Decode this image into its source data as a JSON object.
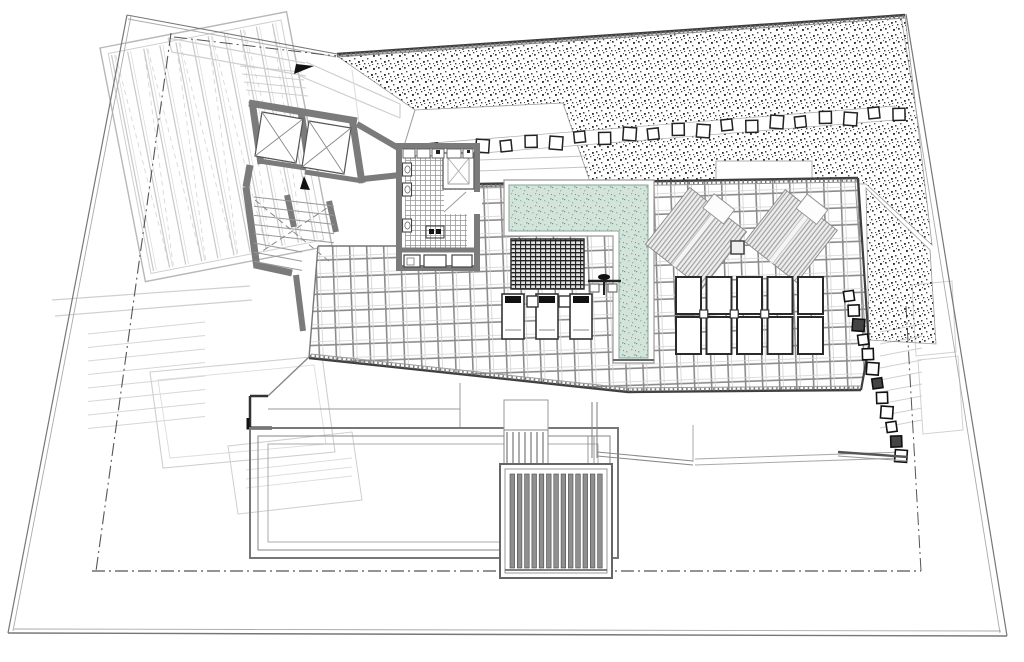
{
  "plan": {
    "type": "architectural-site-plan",
    "level": "roof-terrace-pool-deck",
    "visible_text": [],
    "colors": {
      "background": "#ffffff",
      "wall": "#7b7b7b",
      "line_dark": "#3f3f3f",
      "line_mid": "#8a8a8a",
      "line_light": "#aaaaaa",
      "line_faint": "#cfcfcf",
      "stipple_dot": "#3c3c3c",
      "pool_water": "#d4e4da",
      "pool_dot": "#8fb4a2",
      "pool_dot_dark": "#6e9b87",
      "tile_joint": "#8c8c8c",
      "tile_joint_light": "#d2d2d2",
      "slat_fill": "#8f8f8f",
      "fixture_dark": "#111111",
      "umbrella_stripe": "#a3a3a3",
      "umbrella_bg": "#ededed"
    },
    "features": {
      "elevator_shafts": 2,
      "core_stair_treads": 8,
      "pergola_slats": 11,
      "stepping_stones_upper": 20,
      "stepping_stones_right": 12,
      "pool_loungers": 3,
      "lounger_side_tables": 2,
      "outdoor_showers": 1,
      "umbrellas": 2,
      "deck_sunbed_rows": 2,
      "deck_sunbed_cols": 5,
      "sunbed_connectors": 3,
      "louver_skylight_slats": 13,
      "small_stair_treads": 7,
      "right_stair_treads": 9,
      "left_terrace_treads": 8,
      "court_step_lines": 2
    }
  }
}
